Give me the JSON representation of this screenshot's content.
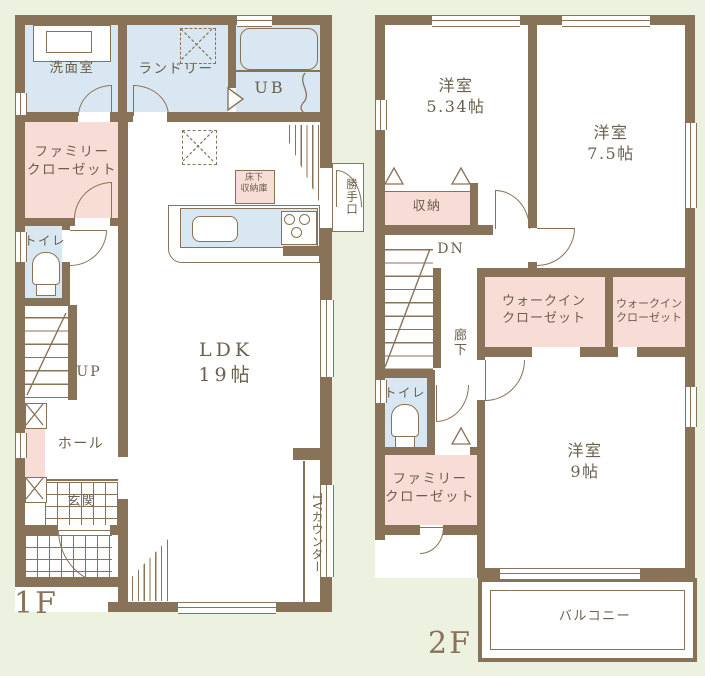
{
  "title": "間取り図（1F・2F）",
  "colors": {
    "wall": "#897358",
    "background": "#edf2e0",
    "wet_area_blue": "#d9e7f3",
    "closet_pink": "#f8dcd6",
    "label_text": "#6b604d"
  },
  "floor1": {
    "label": "1F",
    "rooms": {
      "washroom": "洗面室",
      "laundry": "ランドリー",
      "bath": "UB",
      "family_closet": "ファミリー\nクローゼット",
      "toilet": "トイレ",
      "stairs_up": "UP",
      "hall": "ホール",
      "entrance": "玄関",
      "ldk": "LDK\n19帖",
      "underfloor_storage": "床下\n収納庫",
      "back_door": "勝手口",
      "tv_counter": "TVカウンター"
    }
  },
  "floor2": {
    "label": "2F",
    "rooms": {
      "bedroom1": "洋室\n5.34帖",
      "bedroom2": "洋室\n7.5帖",
      "storage": "収納",
      "stairs_down": "DN",
      "corridor": "廊下",
      "walkin_closet1": "ウォークイン\nクローゼット",
      "walkin_closet2": "ウォークイン\nクローゼット",
      "toilet": "トイレ",
      "family_closet": "ファミリー\nクローゼット",
      "bedroom3": "洋室\n9帖",
      "balcony": "バルコニー"
    }
  }
}
